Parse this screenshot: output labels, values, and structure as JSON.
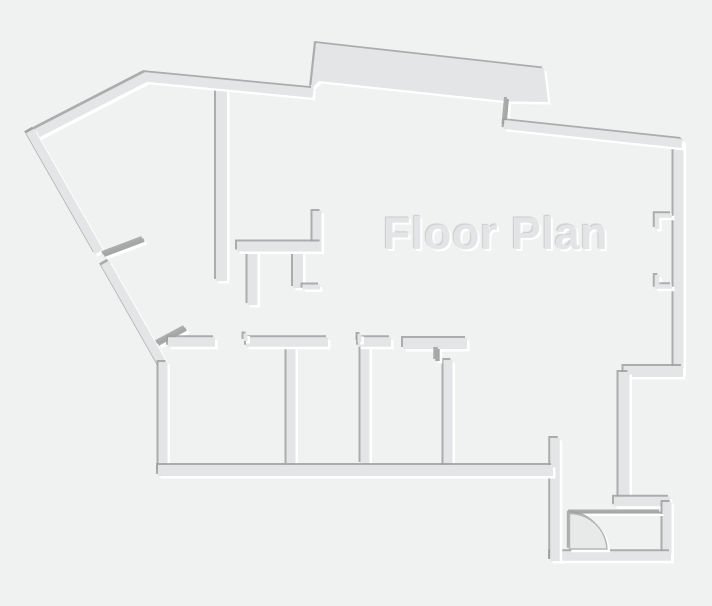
{
  "title": "Floor Plan",
  "palette": {
    "background": "#f0f1f1",
    "wall": "#e3e5e6",
    "mark": "#a6a7a7",
    "emboss_shadow": "#9fa1a1",
    "emboss_highlight": "#ffffff",
    "door_fill": "#e8eaea",
    "door_stroke": "#b2b4b4",
    "title_color": "#e3e4e5"
  },
  "canvas": {
    "width": 712,
    "height": 606
  },
  "floorplan": {
    "walls": [
      {
        "name": "partition-center",
        "kind": "wall",
        "d": "M 221.5 90 L 221.5 281",
        "w": 11
      },
      {
        "name": "wall-top",
        "kind": "wall",
        "d": "M 29.5 137 L 146 77 L 313 93",
        "w": 9.5
      },
      {
        "name": "porch-slab",
        "kind": "slab",
        "d": "M 311 89 L 316 43 L 544 68.5 L 548 102 L 510 101.5 L 319 81 Z",
        "w": 0
      },
      {
        "name": "jamb-top-right",
        "kind": "mark",
        "d": "M 507.5 99 L 505 126",
        "w": 3
      },
      {
        "name": "wall-right-upper",
        "kind": "wall",
        "d": "M 678.5 140 L 678.5 372",
        "w": 10
      },
      {
        "name": "wall-top-right",
        "kind": "wall",
        "d": "M 504 124.5 L 682 143.5",
        "w": 9
      },
      {
        "name": "window-jamb-upper",
        "kind": "wall",
        "d": "M 672 215.5 L 657 215.5 L 657 229",
        "w": 4.5
      },
      {
        "name": "window-jamb-lower",
        "kind": "wall",
        "d": "M 657 275 L 657 286.5 L 672 286.5",
        "w": 4.5
      },
      {
        "name": "wall-step-upper",
        "kind": "wall",
        "d": "M 683 371.5 L 623.5 371.5",
        "w": 11
      },
      {
        "name": "wall-right-mid",
        "kind": "wall",
        "d": "M 624 372 L 624 502",
        "w": 11
      },
      {
        "name": "wall-step-lower",
        "kind": "wall",
        "d": "M 614 501.5 L 670 501.5",
        "w": 9.5
      },
      {
        "name": "wall-right-lower",
        "kind": "wall",
        "d": "M 667 561 L 667 502",
        "w": 9
      },
      {
        "name": "wall-bottom-entry",
        "kind": "wall",
        "d": "M 550 556 L 671 556",
        "w": 9.5
      },
      {
        "name": "wall-entry-left",
        "kind": "wall",
        "d": "M 555 561 L 555 438",
        "w": 9.5
      },
      {
        "name": "door-header-line",
        "kind": "mark",
        "d": "M 570 512.5 L 661 512.5",
        "w": 2
      },
      {
        "name": "door-swing-arc",
        "kind": "door",
        "d": "M 569.5 549 L 569.5 513.5 A 37.5 37.5 0 0 1 607 549 Z",
        "w": 1.4
      },
      {
        "name": "wall-diagonal-upper",
        "kind": "wall",
        "d": "M 30 131 L 99 252",
        "w": 9
      },
      {
        "name": "wall-diagonal-lower",
        "kind": "wall",
        "d": "M 105 263 L 163.5 366",
        "w": 9
      },
      {
        "name": "door-leaf-diagonal",
        "kind": "mark",
        "d": "M 104 255 L 144 240",
        "w": 4
      },
      {
        "name": "wall-left",
        "kind": "wall",
        "d": "M 163 362 L 163 472",
        "w": 9
      },
      {
        "name": "door-leaf-corner",
        "kind": "mark",
        "d": "M 158 344 L 186 329",
        "w": 4
      },
      {
        "name": "closet-stub-left",
        "kind": "wall",
        "d": "M 252.5 250 L 252.5 305",
        "w": 10
      },
      {
        "name": "closet-stub-right",
        "kind": "wall",
        "d": "M 298 250 L 298 288",
        "w": 10
      },
      {
        "name": "closet-foot",
        "kind": "wall",
        "d": "M 302.5 287 L 320 287",
        "w": 5
      },
      {
        "name": "closet-stub-up",
        "kind": "wall",
        "d": "M 317 250 L 317 211",
        "w": 9
      },
      {
        "name": "closet-wall",
        "kind": "wall",
        "d": "M 237 246.5 L 321.5 246.5",
        "w": 10
      },
      {
        "name": "partition-room-1",
        "kind": "wall",
        "d": "M 291 347 L 291 465",
        "w": 9
      },
      {
        "name": "partition-room-2",
        "kind": "wall",
        "d": "M 365 344 L 365 464",
        "w": 9
      },
      {
        "name": "partition-room-3",
        "kind": "wall",
        "d": "M 448 360 L 448 467",
        "w": 9
      },
      {
        "name": "room-wall-a",
        "kind": "wall",
        "d": "M 168 342 L 215 342",
        "w": 9.5
      },
      {
        "name": "room-wall-b",
        "kind": "wall",
        "d": "M 246 342 L 328 342",
        "w": 9.5
      },
      {
        "name": "door-jamb-b",
        "kind": "wall",
        "d": "M 245.5 341 L 245.5 333.5",
        "w": 4
      },
      {
        "name": "room-wall-c",
        "kind": "wall",
        "d": "M 358 342 L 391 342",
        "w": 9.5
      },
      {
        "name": "door-jamb-c",
        "kind": "wall",
        "d": "M 359.5 342 L 359.5 334",
        "w": 4
      },
      {
        "name": "room-wall-t-bar",
        "kind": "wall",
        "d": "M 403 343.5 L 467 343.5",
        "w": 11
      },
      {
        "name": "door-jamb-t",
        "kind": "mark",
        "d": "M 437.5 349 L 437.5 361",
        "w": 4.5
      },
      {
        "name": "wall-bottom-rooms",
        "kind": "wall",
        "d": "M 158 470.5 L 553 470.5",
        "w": 11
      }
    ]
  }
}
